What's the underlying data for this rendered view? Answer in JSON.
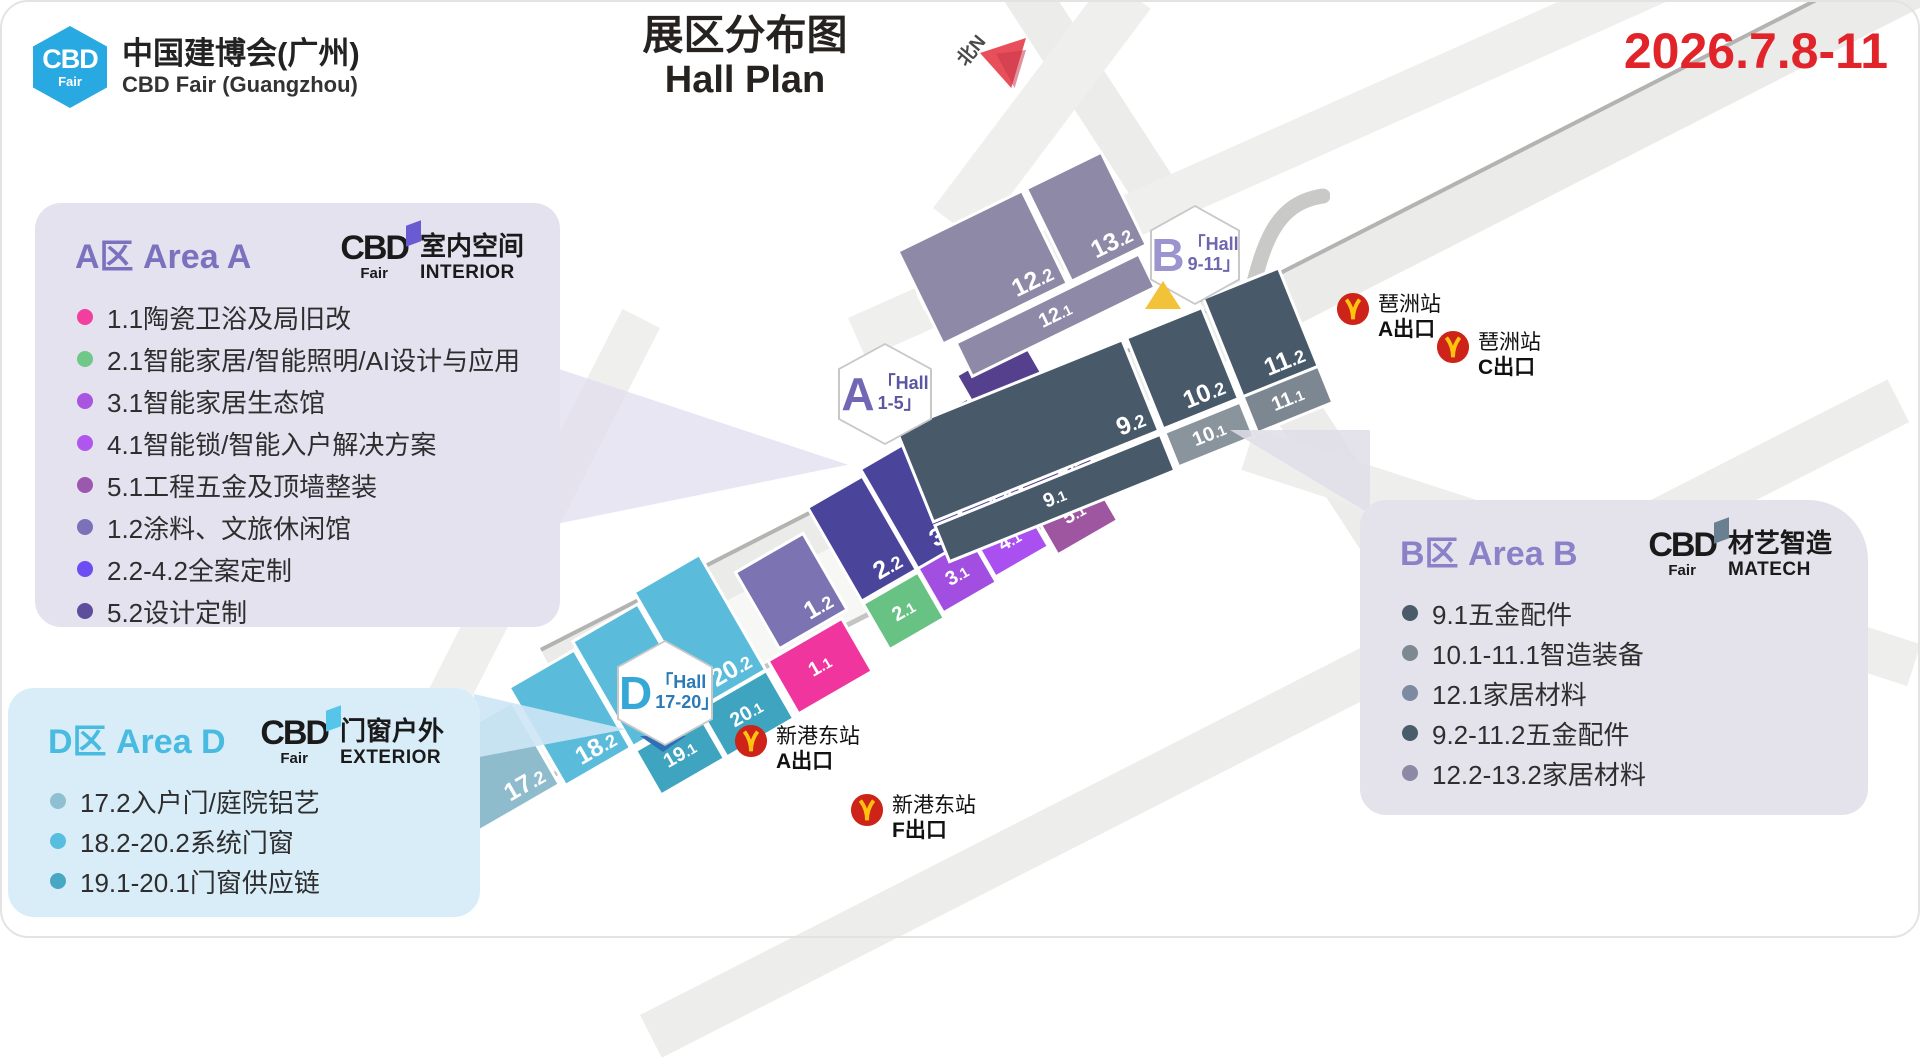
{
  "header": {
    "logo": {
      "cbd": "CBD",
      "fair": "Fair"
    },
    "brand_cn": "中国建博会(广州)",
    "brand_en": "CBD Fair (Guangzhou)",
    "title_cn": "展区分布图",
    "title_en": "Hall Plan",
    "date": "2026.7.8-11",
    "north_label": "北N"
  },
  "panels": {
    "area_a": {
      "title": "A区 Area A",
      "logo": {
        "cbd": "CBD",
        "fair": "Fair",
        "name_cn": "室内空间",
        "name_en": "INTERIOR"
      },
      "accent": "#7B72BF",
      "bg": "#E5E2F0",
      "items": [
        {
          "dot": "#F23E9E",
          "label": "1.1陶瓷卫浴及局旧改"
        },
        {
          "dot": "#6FC788",
          "label": "2.1智能家居/智能照明/AI设计与应用"
        },
        {
          "dot": "#A855E0",
          "label": "3.1智能家居生态馆"
        },
        {
          "dot": "#AE56EE",
          "label": "4.1智能锁/智能入户解决方案"
        },
        {
          "dot": "#9C58AE",
          "label": "5.1工程五金及顶墙整装"
        },
        {
          "dot": "#7A71B8",
          "label": "1.2涂料、文旅休闲馆"
        },
        {
          "dot": "#6C4DF2",
          "label": "2.2-4.2全案定制"
        },
        {
          "dot": "#5E4D9C",
          "label": "5.2设计定制"
        }
      ]
    },
    "area_d": {
      "title": "D区 Area D",
      "logo": {
        "cbd": "CBD",
        "fair": "Fair",
        "name_cn": "门窗户外",
        "name_en": "EXTERIOR"
      },
      "accent": "#49BBE0",
      "bg": "#D9EDF9",
      "items": [
        {
          "dot": "#8FC0D2",
          "label": "17.2入户门/庭院铝艺"
        },
        {
          "dot": "#57BEE0",
          "label": "18.2-20.2系统门窗"
        },
        {
          "dot": "#48A8C4",
          "label": "19.1-20.1门窗供应链"
        }
      ]
    },
    "area_b": {
      "title": "B区 Area B",
      "logo": {
        "cbd": "CBD",
        "fair": "Fair",
        "name_cn": "材艺智造",
        "name_en": "MATECH"
      },
      "accent": "#8A81C8",
      "bg": "#E4E3EC",
      "items": [
        {
          "dot": "#4A5B6A",
          "label": "9.1五金配件"
        },
        {
          "dot": "#7E8891",
          "label": "10.1-11.1智造装备"
        },
        {
          "dot": "#7E89A2",
          "label": "12.1家居材料"
        },
        {
          "dot": "#4A5B6A",
          "label": "9.2-11.2五金配件"
        },
        {
          "dot": "#8C89A5",
          "label": "12.2-13.2家居材料"
        }
      ]
    }
  },
  "map": {
    "badges": [
      {
        "id": "A",
        "letter": "A",
        "line1": "「Hall",
        "line2": "1-5」"
      },
      {
        "id": "B",
        "letter": "B",
        "line1": "「Hall",
        "line2": "9-11」"
      },
      {
        "id": "D",
        "letter": "D",
        "line1": "「Hall",
        "line2": "17-20」"
      }
    ],
    "stations": [
      {
        "name": "琶洲站",
        "exit": "A出口"
      },
      {
        "name": "琶洲站",
        "exit": "C出口"
      },
      {
        "name": "新港东站",
        "exit": "A出口"
      },
      {
        "name": "新港东站",
        "exit": "F出口"
      }
    ],
    "halls": {
      "area_a": [
        {
          "label": "1.2",
          "color": "#7C73B2"
        },
        {
          "label": "2.2",
          "color": "#4A449B"
        },
        {
          "label": "3.2",
          "color": "#4A449B"
        },
        {
          "label": "4.2",
          "color": "#4A449B"
        },
        {
          "label": "5.2",
          "color": "#55408D"
        },
        {
          "label": "1.1",
          "color": "#F0369E"
        },
        {
          "label": "2.1",
          "color": "#68C284"
        },
        {
          "label": "3.1",
          "color": "#A24EE0"
        },
        {
          "label": "4.1",
          "color": "#AA4FF0"
        },
        {
          "label": "5.1",
          "color": "#9D569F"
        }
      ],
      "area_b_south": [
        {
          "label": "9.2",
          "color": "#48596A"
        },
        {
          "label": "10.2",
          "color": "#48596A"
        },
        {
          "label": "11.2",
          "color": "#48596A"
        },
        {
          "label": "9.1",
          "color": "#48596A"
        },
        {
          "label": "10.1",
          "color": "#8A949D"
        },
        {
          "label": "11.1",
          "color": "#7D8791"
        }
      ],
      "area_b_north": [
        {
          "label": "12.2",
          "color": "#8D89A6"
        },
        {
          "label": "13.2",
          "color": "#8D89A6"
        },
        {
          "label": "12.1",
          "color": "#8D89A6"
        }
      ],
      "area_d": [
        {
          "label": "",
          "color": "#8FBCCC"
        },
        {
          "label": "17.2",
          "color": "#8FBCCC"
        },
        {
          "label": "18.2",
          "color": "#5ABCDA"
        },
        {
          "label": "19.2",
          "color": "#5ABCDA"
        },
        {
          "label": "20.2",
          "color": "#5ABCDA"
        },
        {
          "label": "19.1",
          "color": "#3FA4C0"
        },
        {
          "label": "20.1",
          "color": "#3FA4C0"
        }
      ]
    }
  }
}
